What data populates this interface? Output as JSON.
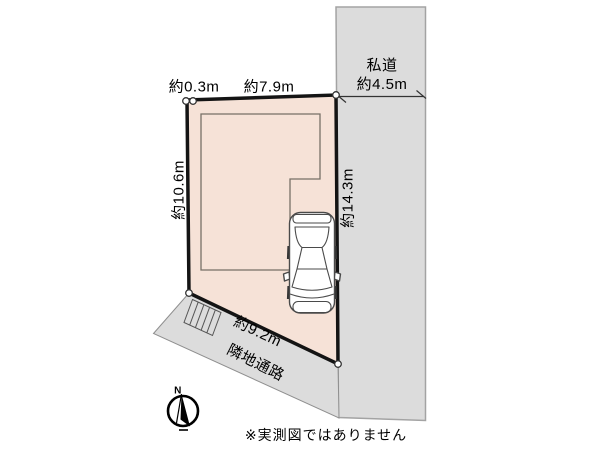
{
  "colors": {
    "lot_fill": "#f6e2d7",
    "lot_border": "#141414",
    "road_fill": "#dcdcdc",
    "road_edge": "#a3a3a3",
    "passage_edge": "#8f8f8f"
  },
  "lot": {
    "dim_top_small": "約0.3m",
    "dim_top": "約7.9m",
    "dim_left": "約10.6m",
    "dim_right": "約14.3m",
    "dim_bottom": "約9.2m"
  },
  "side_road": {
    "name": "私道",
    "width": "約4.5m"
  },
  "passage": {
    "label": "隣地通路"
  },
  "compass": {
    "north": "N"
  },
  "footer": {
    "disclaimer": "※実測図ではありません"
  }
}
